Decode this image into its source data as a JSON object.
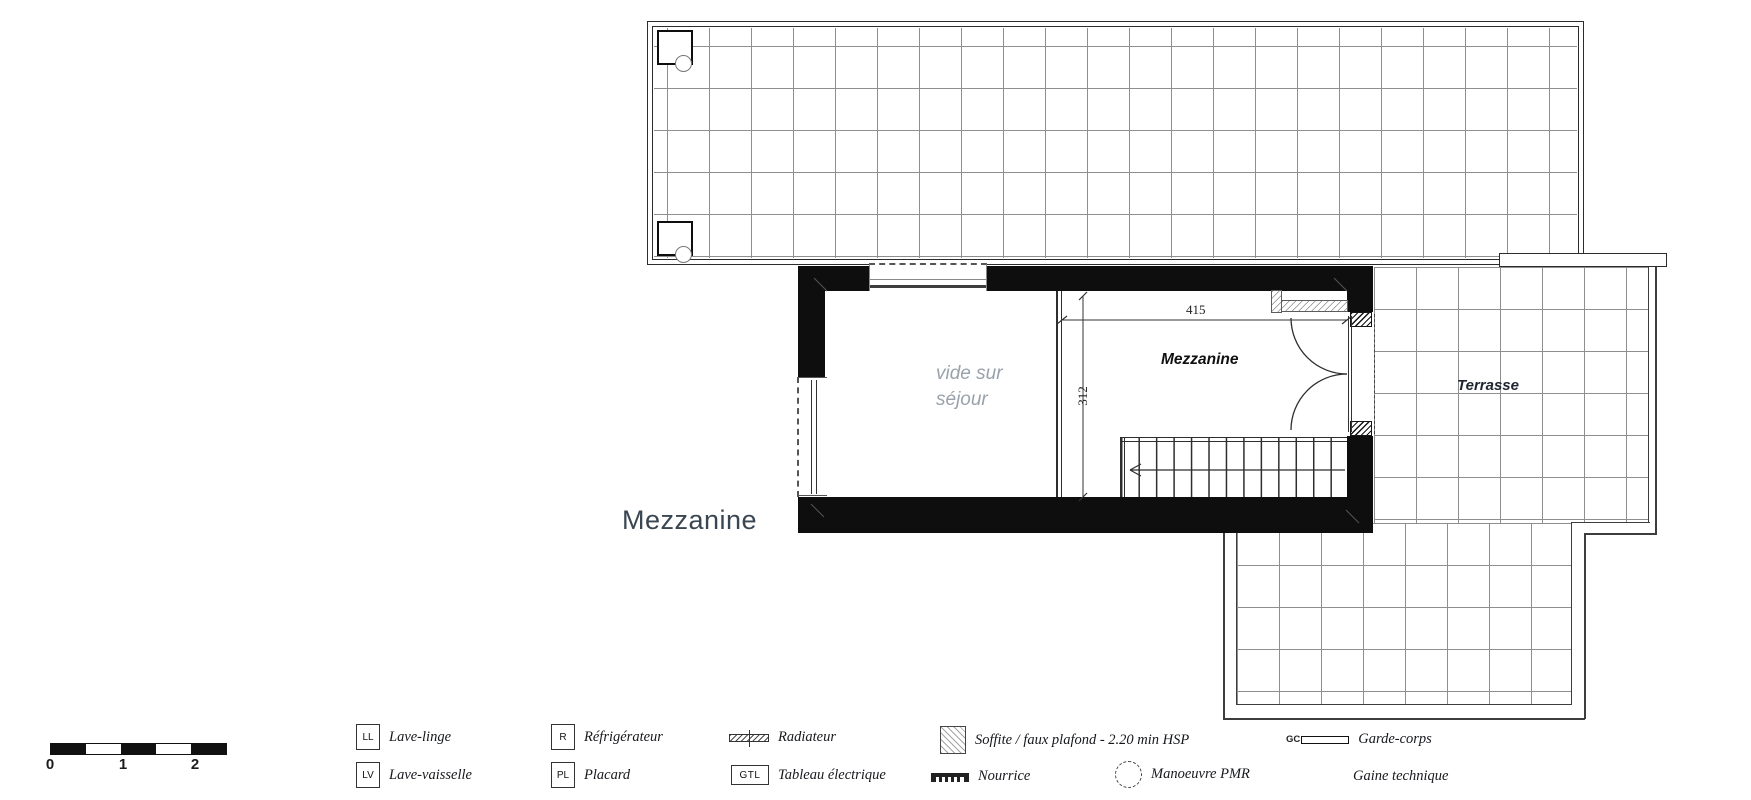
{
  "floor_label": "Mezzanine",
  "rooms": {
    "void_line1": "vide sur",
    "void_line2": "séjour",
    "mezzanine": "Mezzanine",
    "terrasse": "Terrasse"
  },
  "dimensions": {
    "width": "415",
    "depth": "312"
  },
  "scale_bar": {
    "tick0": "0",
    "tick1": "1",
    "tick2": "2"
  },
  "legend": {
    "items": [
      {
        "id": "lave-linge",
        "code": "LL",
        "label": "Lave-linge"
      },
      {
        "id": "lave-vaisselle",
        "code": "LV",
        "label": "Lave-vaisselle"
      },
      {
        "id": "refrigerateur",
        "code": "R",
        "label": "Réfrigérateur"
      },
      {
        "id": "placard",
        "code": "PL",
        "label": "Placard"
      },
      {
        "id": "radiateur",
        "label": "Radiateur"
      },
      {
        "id": "tableau-electrique",
        "code": "GTL",
        "label": "Tableau électrique"
      },
      {
        "id": "soffite",
        "label": "Soffite / faux plafond - 2.20 min HSP"
      },
      {
        "id": "nourrice",
        "label": "Nourrice"
      },
      {
        "id": "manoeuvre-pmr",
        "label": "Manoeuvre PMR"
      },
      {
        "id": "garde-corps",
        "code": "GC",
        "label": "Garde-corps"
      },
      {
        "id": "gaine-technique",
        "label": "Gaine technique"
      }
    ]
  },
  "colors": {
    "wall": "#0e0e0e",
    "outline": "#3d3d3d",
    "grid": "#8e8e8e",
    "line": "#2e2e2e",
    "text": "#16181c",
    "void": "#99a2ab",
    "floor": "#3a4652"
  }
}
